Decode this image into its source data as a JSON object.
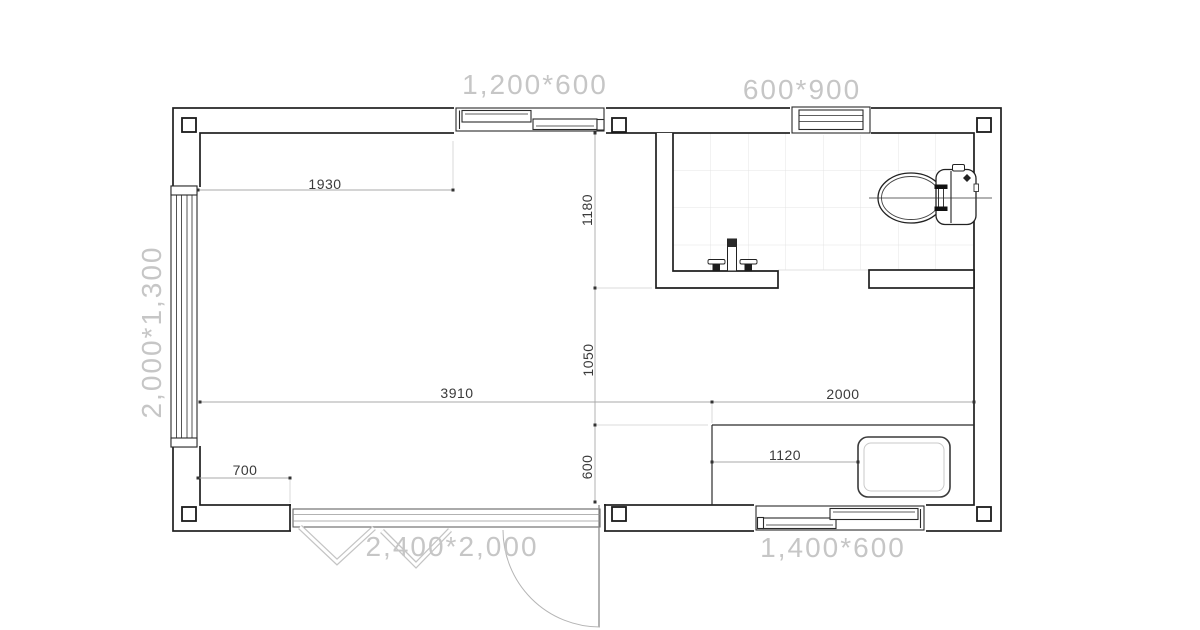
{
  "plan_type": "floor-plan",
  "sizes": {
    "top_window": "1,200*600",
    "bath_window": "600*900",
    "left_window": "2,000*1,300",
    "entry_door": "2,400*2,000",
    "bottom_window": "1,400*600"
  },
  "dims": {
    "w1930": "1930",
    "h1180": "1180",
    "h1050": "1050",
    "h600": "600",
    "w3910": "3910",
    "w2000": "2000",
    "w1120": "1120",
    "w700": "700"
  },
  "fixtures": [
    "toilet-icon",
    "faucet-icon",
    "basin-icon",
    "door-swing-icon",
    "bifold-door-icon",
    "sliding-window-icon"
  ],
  "colors": {
    "wall_line": "#1f1f1f",
    "dim_line": "#a8a8a8",
    "ext_line": "#cfcfcf",
    "dim_text": "#3a3a3a",
    "size_label": "#c6c6c6",
    "tile_line": "#e4e4e4",
    "door_arc": "#b5b5b5",
    "bifold": "#c4c4c4"
  }
}
